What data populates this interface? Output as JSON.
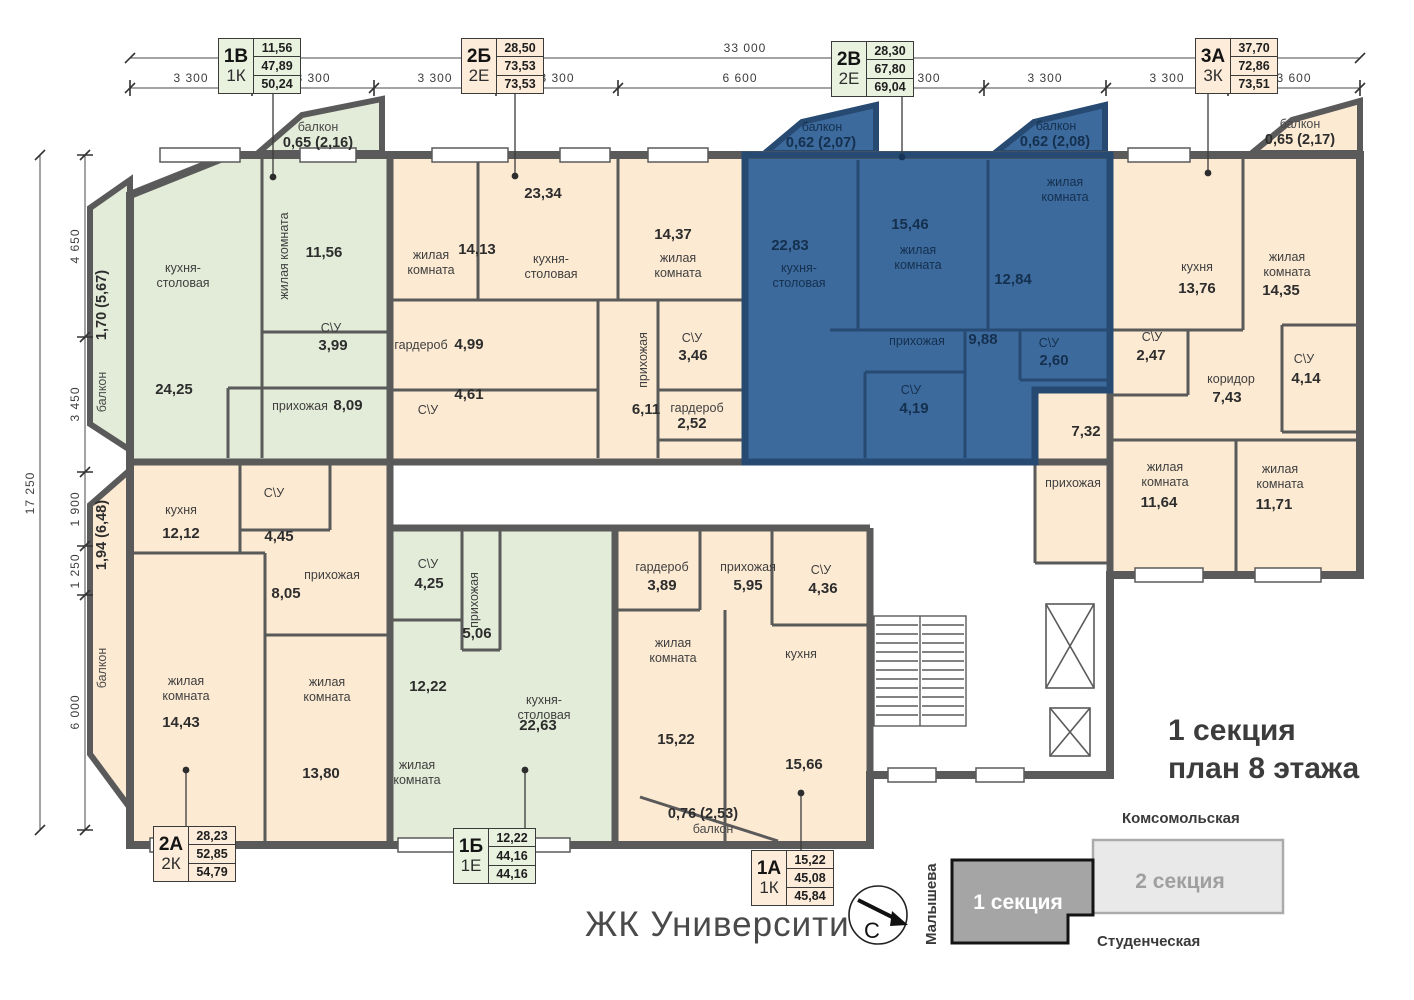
{
  "title": {
    "line1": "1 секция",
    "line2": "план 8 этажа"
  },
  "logo": "ЖК Университи",
  "compass": {
    "letter": "С"
  },
  "minimap": {
    "street_top": "Комсомольская",
    "street_left": "Малышева",
    "street_bottom": "Студенческая",
    "section1": "1 секция",
    "section2": "2 секция"
  },
  "colors": {
    "beige": "#fcead3",
    "green": "#e3ecd8",
    "blue": "#3d6a9d",
    "wall": "#5a5a5a",
    "blue_wall": "#274a72",
    "blue_text": "#14304e"
  },
  "dimensions": {
    "top_total": "33 000",
    "top_segments": [
      "3 300",
      "3 300",
      "3 300",
      "3 300",
      "6 600",
      "3 300",
      "3 300",
      "3 300",
      "3 600"
    ],
    "left_total": "17 250",
    "left_segments": [
      "4 650",
      "3 450",
      "1 900",
      "1 250",
      "6 000"
    ]
  },
  "apartments": [
    {
      "id": "1v",
      "type": "1В",
      "subtype": "1К",
      "values": [
        "11,56",
        "47,89",
        "50,24"
      ],
      "color": "green"
    },
    {
      "id": "2b",
      "type": "2Б",
      "subtype": "2Е",
      "values": [
        "28,50",
        "73,53",
        "73,53"
      ],
      "color": "beige"
    },
    {
      "id": "2v",
      "type": "2В",
      "subtype": "2Е",
      "values": [
        "28,30",
        "67,80",
        "69,04"
      ],
      "color": "green"
    },
    {
      "id": "3a",
      "type": "3А",
      "subtype": "3К",
      "values": [
        "37,70",
        "72,86",
        "73,51"
      ],
      "color": "beige"
    },
    {
      "id": "2a",
      "type": "2А",
      "subtype": "2К",
      "values": [
        "28,23",
        "52,85",
        "54,79"
      ],
      "color": "beige"
    },
    {
      "id": "1b",
      "type": "1Б",
      "subtype": "1Е",
      "values": [
        "12,22",
        "44,16",
        "44,16"
      ],
      "color": "green"
    },
    {
      "id": "1a",
      "type": "1А",
      "subtype": "1К",
      "values": [
        "15,22",
        "45,08",
        "45,84"
      ],
      "color": "beige"
    }
  ],
  "rooms": [
    {
      "id": "r1v_kitchen",
      "name": "кухня-столовая",
      "area": "24,25"
    },
    {
      "id": "r1v_living",
      "name": "жилая комната",
      "area": "11,56"
    },
    {
      "id": "r1v_su",
      "name": "С\\У",
      "area": "3,99"
    },
    {
      "id": "r1v_hall",
      "name": "прихожая",
      "area": "8,09"
    },
    {
      "id": "r2b_living1",
      "name": "жилая комната",
      "area": "14,13"
    },
    {
      "id": "r2b_kitchen",
      "name": "кухня-столовая",
      "area": "23,34"
    },
    {
      "id": "r2b_living2",
      "name": "жилая комната",
      "area": "14,37"
    },
    {
      "id": "r2b_ward1",
      "name": "гардероб",
      "area": "4,99"
    },
    {
      "id": "r2b_su1",
      "name": "С\\У",
      "area": "4,61"
    },
    {
      "id": "r2b_hall",
      "name": "прихожая",
      "area": "6,11"
    },
    {
      "id": "r2b_su2",
      "name": "С\\У",
      "area": "3,46"
    },
    {
      "id": "r2b_ward2",
      "name": "гардероб",
      "area": "2,52"
    },
    {
      "id": "r2v_kitchen",
      "name": "кухня-столовая",
      "area": "22,83"
    },
    {
      "id": "r2v_living1",
      "name": "жилая комната",
      "area": "15,46"
    },
    {
      "id": "r2v_living2",
      "name": "жилая комната",
      "area": "12,84"
    },
    {
      "id": "r2v_hall",
      "name": "прихожая",
      "area": "9,88"
    },
    {
      "id": "r2v_su1",
      "name": "С\\У",
      "area": "4,19"
    },
    {
      "id": "r2v_su2",
      "name": "С\\У",
      "area": "2,60"
    },
    {
      "id": "r3a_kitchen",
      "name": "кухня",
      "area": "13,76"
    },
    {
      "id": "r3a_living1",
      "name": "жилая комната",
      "area": "14,35"
    },
    {
      "id": "r3a_su1",
      "name": "С\\У",
      "area": "2,47"
    },
    {
      "id": "r3a_corr",
      "name": "коридор",
      "area": "7,43"
    },
    {
      "id": "r3a_su2",
      "name": "С\\У",
      "area": "4,14"
    },
    {
      "id": "r3a_hall",
      "name": "прихожая",
      "area": "7,32"
    },
    {
      "id": "r3a_living2",
      "name": "жилая комната",
      "area": "11,64"
    },
    {
      "id": "r3a_living3",
      "name": "жилая комната",
      "area": "11,71"
    },
    {
      "id": "r2a_kitchen",
      "name": "кухня",
      "area": "12,12"
    },
    {
      "id": "r2a_su",
      "name": "С\\У",
      "area": "4,45"
    },
    {
      "id": "r2a_hall",
      "name": "прихожая",
      "area": "8,05"
    },
    {
      "id": "r2a_living1",
      "name": "жилая комната",
      "area": "14,43"
    },
    {
      "id": "r2a_living2",
      "name": "жилая комната",
      "area": "13,80"
    },
    {
      "id": "r1b_su",
      "name": "С\\У",
      "area": "4,25"
    },
    {
      "id": "r1b_hall",
      "name": "прихожая",
      "area": "5,06"
    },
    {
      "id": "r1b_living",
      "name": "жилая комната",
      "area": "12,22"
    },
    {
      "id": "r1b_kitchen",
      "name": "кухня-столовая",
      "area": "22,63"
    },
    {
      "id": "r1a_ward",
      "name": "гардероб",
      "area": "3,89"
    },
    {
      "id": "r1a_hall",
      "name": "прихожая",
      "area": "5,95"
    },
    {
      "id": "r1a_su",
      "name": "С\\У",
      "area": "4,36"
    },
    {
      "id": "r1a_living",
      "name": "жилая комната",
      "area": "15,22"
    },
    {
      "id": "r1a_kitchen",
      "name": "кухня",
      "area": "15,66"
    }
  ],
  "balconies": [
    {
      "id": "bal_1v_top",
      "name": "балкон",
      "value": "0,65 (2,16)"
    },
    {
      "id": "bal_1v_side",
      "name": "балкон",
      "value": "1,70 (5,67)"
    },
    {
      "id": "bal_2v_left",
      "name": "балкон",
      "value": "0,62 (2,07)"
    },
    {
      "id": "bal_2v_right",
      "name": "балкон",
      "value": "0,62 (2,08)"
    },
    {
      "id": "bal_3a_top",
      "name": "балкон",
      "value": "0,65 (2,17)"
    },
    {
      "id": "bal_2a_side",
      "name": "балкон",
      "value": "1,94 (6,48)"
    },
    {
      "id": "bal_1a_bottom",
      "name": "балкон",
      "value": "0,76 (2,53)"
    }
  ]
}
